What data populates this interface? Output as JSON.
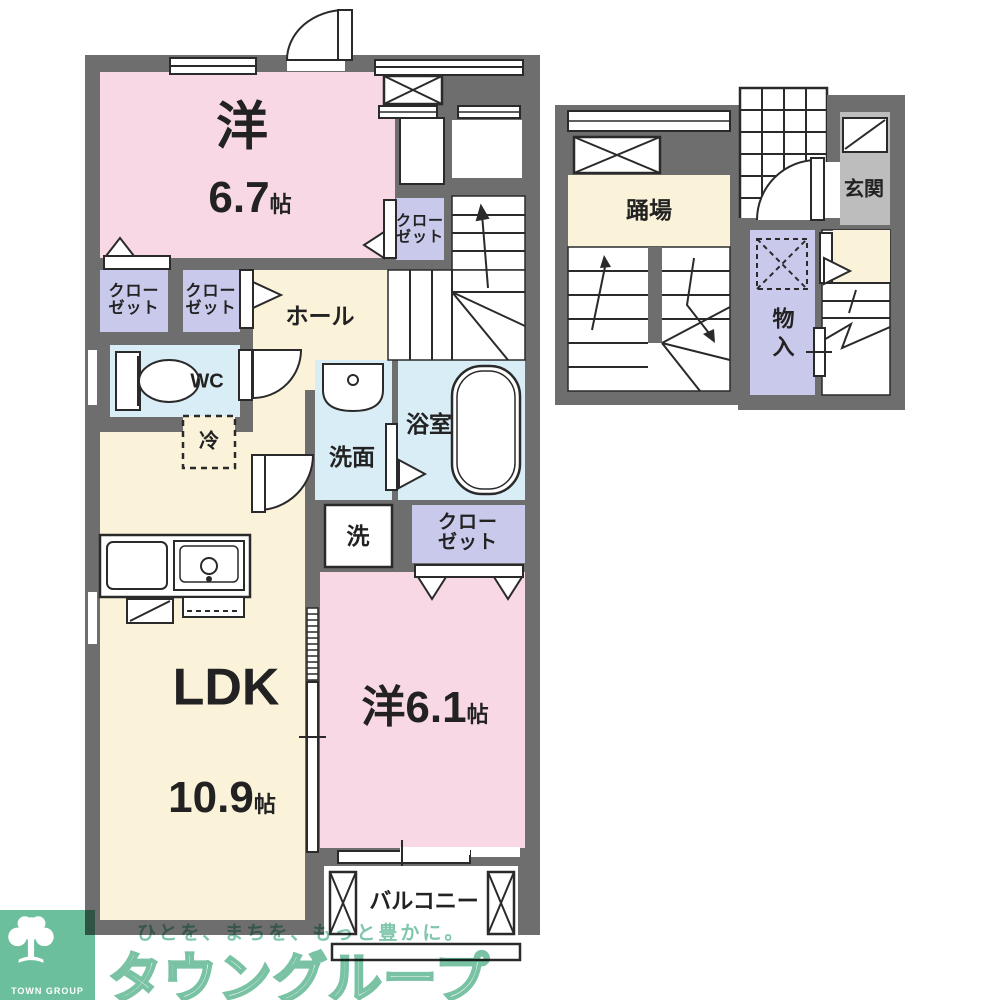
{
  "plan": {
    "unit": {
      "bedroom_a": {
        "name": "洋",
        "area": "6.7",
        "area_unit": "帖"
      },
      "bedroom_b": {
        "name": "洋",
        "area": "6.1",
        "area_unit": "帖"
      },
      "ldk": {
        "name": "LDK",
        "area": "10.9",
        "area_unit": "帖"
      },
      "hall": "ホール",
      "wc": "WC",
      "refrigerator": "冷",
      "washroom": "洗面",
      "bathroom": "浴室",
      "washer": "洗",
      "closet": "クローゼット",
      "balcony": "バルコニー"
    },
    "stairwell": {
      "landing": "踊場"
    },
    "entrance_floor": {
      "entrance": "玄関",
      "storage": "物入"
    }
  },
  "branding": {
    "slogan": "ひとを、まちを、もっと豊かに。",
    "company": "タウングループ",
    "logo_caption": "TOWN GROUP"
  },
  "colors": {
    "wall": "#6e6e6e",
    "room_pink": "#f8d8e4",
    "room_cream": "#faf3da",
    "room_blue": "#d9edf6",
    "closet_purple": "#c9c9ec",
    "entrance_gray": "#bdbdbd",
    "line": "#2a2a2a",
    "brand": "#6cbf9d"
  }
}
